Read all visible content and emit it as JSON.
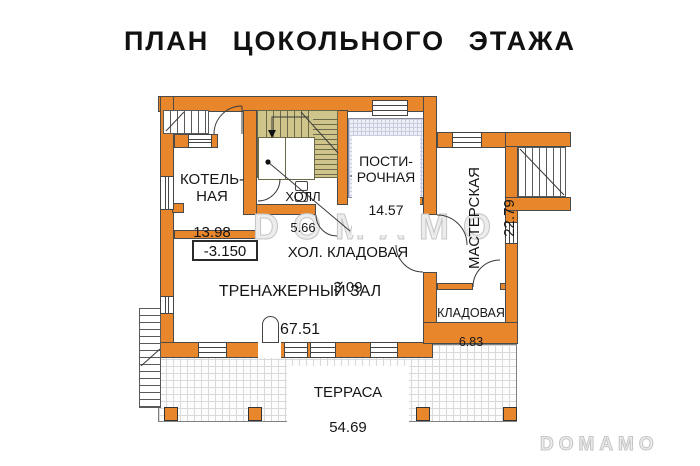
{
  "title": "ПЛАН ЦОКОЛЬНОГО ЭТАЖА",
  "watermarks": {
    "center": "DOMAMO",
    "corner": "DOMAMO"
  },
  "elevation_label": "-3.150",
  "rooms": {
    "boiler": {
      "name": "КОТЕЛЬ-\nНАЯ",
      "area": "13.98"
    },
    "hall": {
      "name": "ХОЛЛ",
      "area": "5.66"
    },
    "laundry": {
      "name": "ПОСТИ-\nРОЧНАЯ",
      "area": "14.57"
    },
    "workshop": {
      "name": "МАСТЕРСКАЯ",
      "area": "22.79"
    },
    "cold_pantry": {
      "name": "ХОЛ. КЛАДОВАЯ",
      "area": "3.09"
    },
    "gym": {
      "name": "ТРЕНАЖЕРНЫЙ ЗАЛ",
      "area": "67.51"
    },
    "storage": {
      "name": "КЛАДОВАЯ",
      "area": "6.83"
    },
    "terrace": {
      "name": "ТЕРРАСА",
      "area": "54.69"
    }
  },
  "colors": {
    "wall": "#E8862C",
    "stair": "#CFC58B",
    "tile_floor": "#EEF0F7",
    "outline": "#4A4A4A"
  }
}
